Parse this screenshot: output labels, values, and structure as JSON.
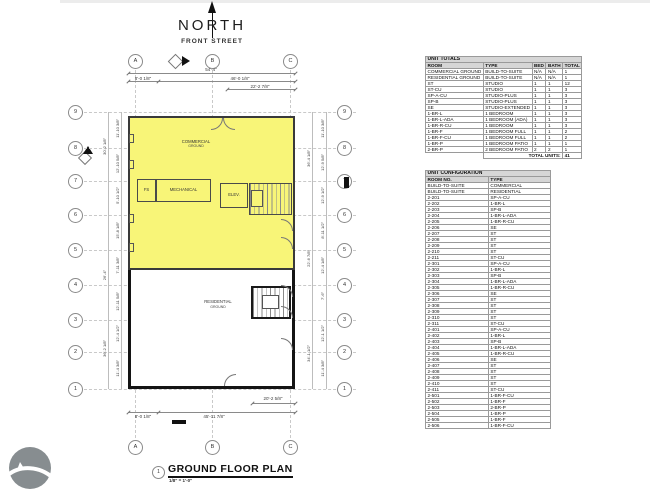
{
  "drawing": {
    "north_label": "NORTH",
    "street_label": "FRONT STREET",
    "title_number": "1",
    "title": "GROUND FLOOR PLAN",
    "scale": "1/8\" = 1'-0\"",
    "colors": {
      "highlight": "#f8f578"
    },
    "rooms": {
      "commercial": {
        "name": "COMMERCIAL",
        "sub": "GROUND"
      },
      "residential": {
        "name": "RESIDENTIAL",
        "sub": "GROUND"
      },
      "fs": "FS",
      "mechanical": "MECHANICAL",
      "elevator": "ELEV."
    },
    "grid": {
      "columns": [
        "A",
        "B",
        "C"
      ],
      "rows": [
        "9",
        "8",
        "7",
        "6",
        "5",
        "4",
        "3",
        "2",
        "1"
      ]
    },
    "dimensions": {
      "top_overall": "54'-4\"",
      "top_left": "8'-0 1/8\"",
      "top_right": "46'-0 1/8\"",
      "top_partial": "22'-2 7/8\"",
      "bottom_partial": "20'-2 5/8\"",
      "bottom_left": "8'-0 1/8\"",
      "bottom_overall": "45'-11 7/8\"",
      "left_bays": [
        "11'-10 3/8\"",
        "12'-10 5/8\"",
        "5'-10 1/2\"",
        "15'-8 1/8\"",
        "7'-11 3/8\"",
        "12'-11 5/8\"",
        "12'-4 1/2\"",
        "11'-4 3/8\""
      ],
      "left_overall": [
        "30'-2 1/8\"",
        "26'-4\"",
        "36'-2 1/8\""
      ],
      "right_bays": [
        "11'-10 3/8\"",
        "12'-9 5/8\"",
        "12'-9 1/2\"",
        "8'-11 1/2\"",
        "12'-4 1/8\"",
        "7'-6\"",
        "12'-1 1/2\"",
        "11'-4 3/8\""
      ],
      "right_overall": [
        "36'-4 1/8\"",
        "22'-6 7/8\"",
        "34'-1 1/2\""
      ]
    }
  },
  "unit_totals": {
    "title": "UNIT TOTALS",
    "columns": [
      "ROOM",
      "TYPE",
      "BED",
      "BATH",
      "TOTAL"
    ],
    "rows": [
      [
        "COMMERCIAL GROUND",
        "BUILD-TO-SUITE",
        "N/A",
        "N/A",
        "1"
      ],
      [
        "RESIDENTIAL GROUND",
        "BUILD-TO-SUITE",
        "N/A",
        "N/A",
        "1"
      ],
      [
        "ST",
        "STUDIO",
        "1",
        "1",
        "12"
      ],
      [
        "ST-CU",
        "STUDIO",
        "1",
        "1",
        "3"
      ],
      [
        "SP-A-CU",
        "STUDIO-PLUS",
        "1",
        "1",
        "3"
      ],
      [
        "SP-B",
        "STUDIO-PLUS",
        "1",
        "1",
        "3"
      ],
      [
        "SE",
        "STUDIO-EXTENDED",
        "1",
        "1",
        "3"
      ],
      [
        "1-BR-L",
        "1 BEDROOM",
        "1",
        "1",
        "3"
      ],
      [
        "1-BR-L-ADA",
        "1 BEDROOM (ADA)",
        "1",
        "1",
        "3"
      ],
      [
        "1-BR-R-CU",
        "1 BEDROOM",
        "1",
        "1",
        "3"
      ],
      [
        "1-BR-F",
        "1 BEDROOM FULL",
        "1",
        "1",
        "2"
      ],
      [
        "1-BR-F-CU",
        "1 BEDROOM FULL",
        "1",
        "1",
        "2"
      ],
      [
        "1-BR-P",
        "1 BEDROOM PATIO",
        "1",
        "1",
        "1"
      ],
      [
        "2-BR-P",
        "2 BEDROOM PATIO",
        "2",
        "2",
        "1"
      ]
    ],
    "total_label": "TOTAL UNITS:",
    "total_value": "41"
  },
  "unit_configuration": {
    "title": "UNIT CONFIGURATION",
    "columns": [
      "ROOM NO.",
      "TYPE"
    ],
    "rows": [
      [
        "BUILD-TO-SUITE",
        "COMMERCIAL"
      ],
      [
        "BUILD-TO-SUITE",
        "RESIDENTIAL"
      ],
      [
        "2-201",
        "SP-A-CU"
      ],
      [
        "2-202",
        "1-BR-L"
      ],
      [
        "2-203",
        "SP-B"
      ],
      [
        "2-204",
        "1-BR-L-ADA"
      ],
      [
        "2-205",
        "1-BR-R-CU"
      ],
      [
        "2-206",
        "SE"
      ],
      [
        "2-207",
        "ST"
      ],
      [
        "2-208",
        "ST"
      ],
      [
        "2-209",
        "ST"
      ],
      [
        "2-210",
        "ST"
      ],
      [
        "2-211",
        "ST-CU"
      ],
      [
        "2-301",
        "SP-A-CU"
      ],
      [
        "2-302",
        "1-BR-L"
      ],
      [
        "2-303",
        "SP-B"
      ],
      [
        "2-304",
        "1-BR-L-ADA"
      ],
      [
        "2-305",
        "1-BR-R-CU"
      ],
      [
        "2-306",
        "SE"
      ],
      [
        "2-307",
        "ST"
      ],
      [
        "2-308",
        "ST"
      ],
      [
        "2-309",
        "ST"
      ],
      [
        "2-310",
        "ST"
      ],
      [
        "2-311",
        "ST-CU"
      ],
      [
        "2-401",
        "SP-A-CU"
      ],
      [
        "2-402",
        "1-BR-L"
      ],
      [
        "2-403",
        "SP-B"
      ],
      [
        "2-404",
        "1-BR-L-ADA"
      ],
      [
        "2-405",
        "1-BR-R-CU"
      ],
      [
        "2-406",
        "SE"
      ],
      [
        "2-407",
        "ST"
      ],
      [
        "2-408",
        "ST"
      ],
      [
        "2-409",
        "ST"
      ],
      [
        "2-410",
        "ST"
      ],
      [
        "2-411",
        "ST-CU"
      ],
      [
        "2-501",
        "1-BR-F-CU"
      ],
      [
        "2-502",
        "1-BR-F"
      ],
      [
        "2-503",
        "2-BR-P"
      ],
      [
        "2-504",
        "1-BR-P"
      ],
      [
        "2-505",
        "1-BR-F"
      ],
      [
        "2-506",
        "1-BR-F-CU"
      ]
    ]
  }
}
